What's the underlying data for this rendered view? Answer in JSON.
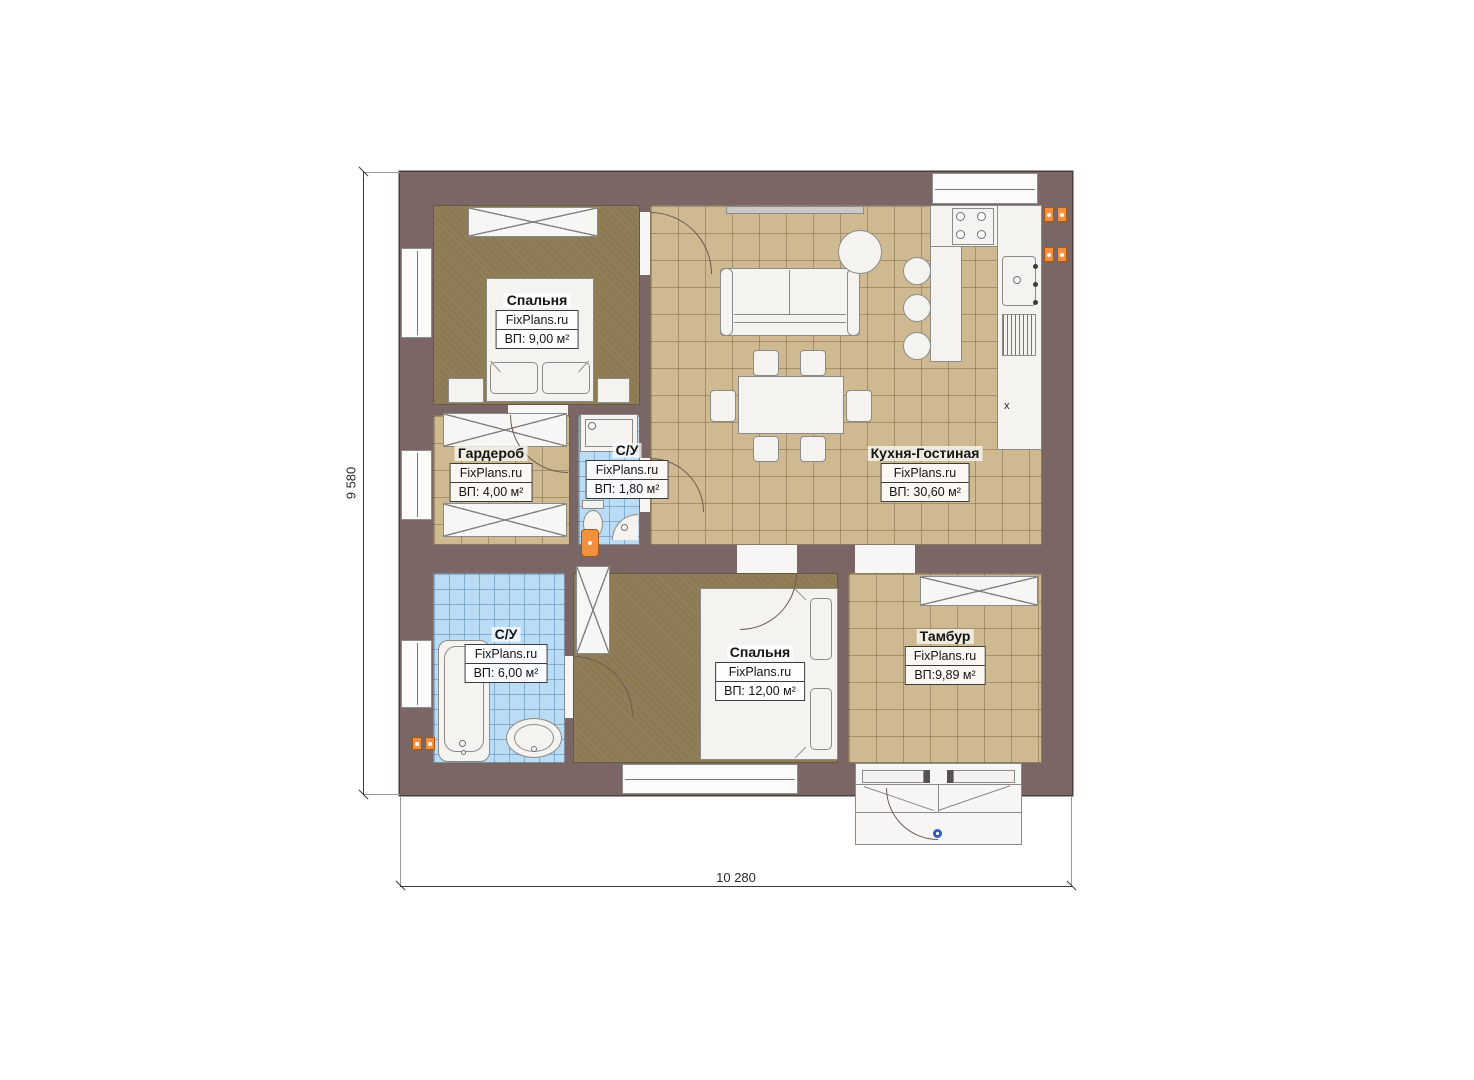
{
  "plan": {
    "watermark": "FixPlans.ru",
    "dimensions": {
      "height": "9 580",
      "width": "10 280"
    },
    "rooms": [
      {
        "id": "bedroom-1",
        "name": "Спальня",
        "area": "ВП: 9,00 м²"
      },
      {
        "id": "wardrobe",
        "name": "Гардероб",
        "area": "ВП: 4,00 м²"
      },
      {
        "id": "bathroom-small",
        "name": "С/У",
        "area": "ВП: 1,80 м²"
      },
      {
        "id": "kitchen-living",
        "name": "Кухня-Гостиная",
        "area": "ВП: 30,60 м²"
      },
      {
        "id": "bathroom-main",
        "name": "С/У",
        "area": "ВП: 6,00 м²"
      },
      {
        "id": "bedroom-2",
        "name": "Спальня",
        "area": "ВП: 12,00 м²"
      },
      {
        "id": "vestibule",
        "name": "Тамбур",
        "area": "ВП:9,89 м²"
      }
    ],
    "marks": {
      "appliance_x": "x"
    },
    "colors": {
      "wall": "#7a6765",
      "floor_wood": "#8c7a53",
      "floor_tile_tan": "#cfb990",
      "floor_tile_blue": "#badcf5",
      "accent_orange": "#f29040",
      "hinge_blue": "#2f5fc0"
    }
  }
}
